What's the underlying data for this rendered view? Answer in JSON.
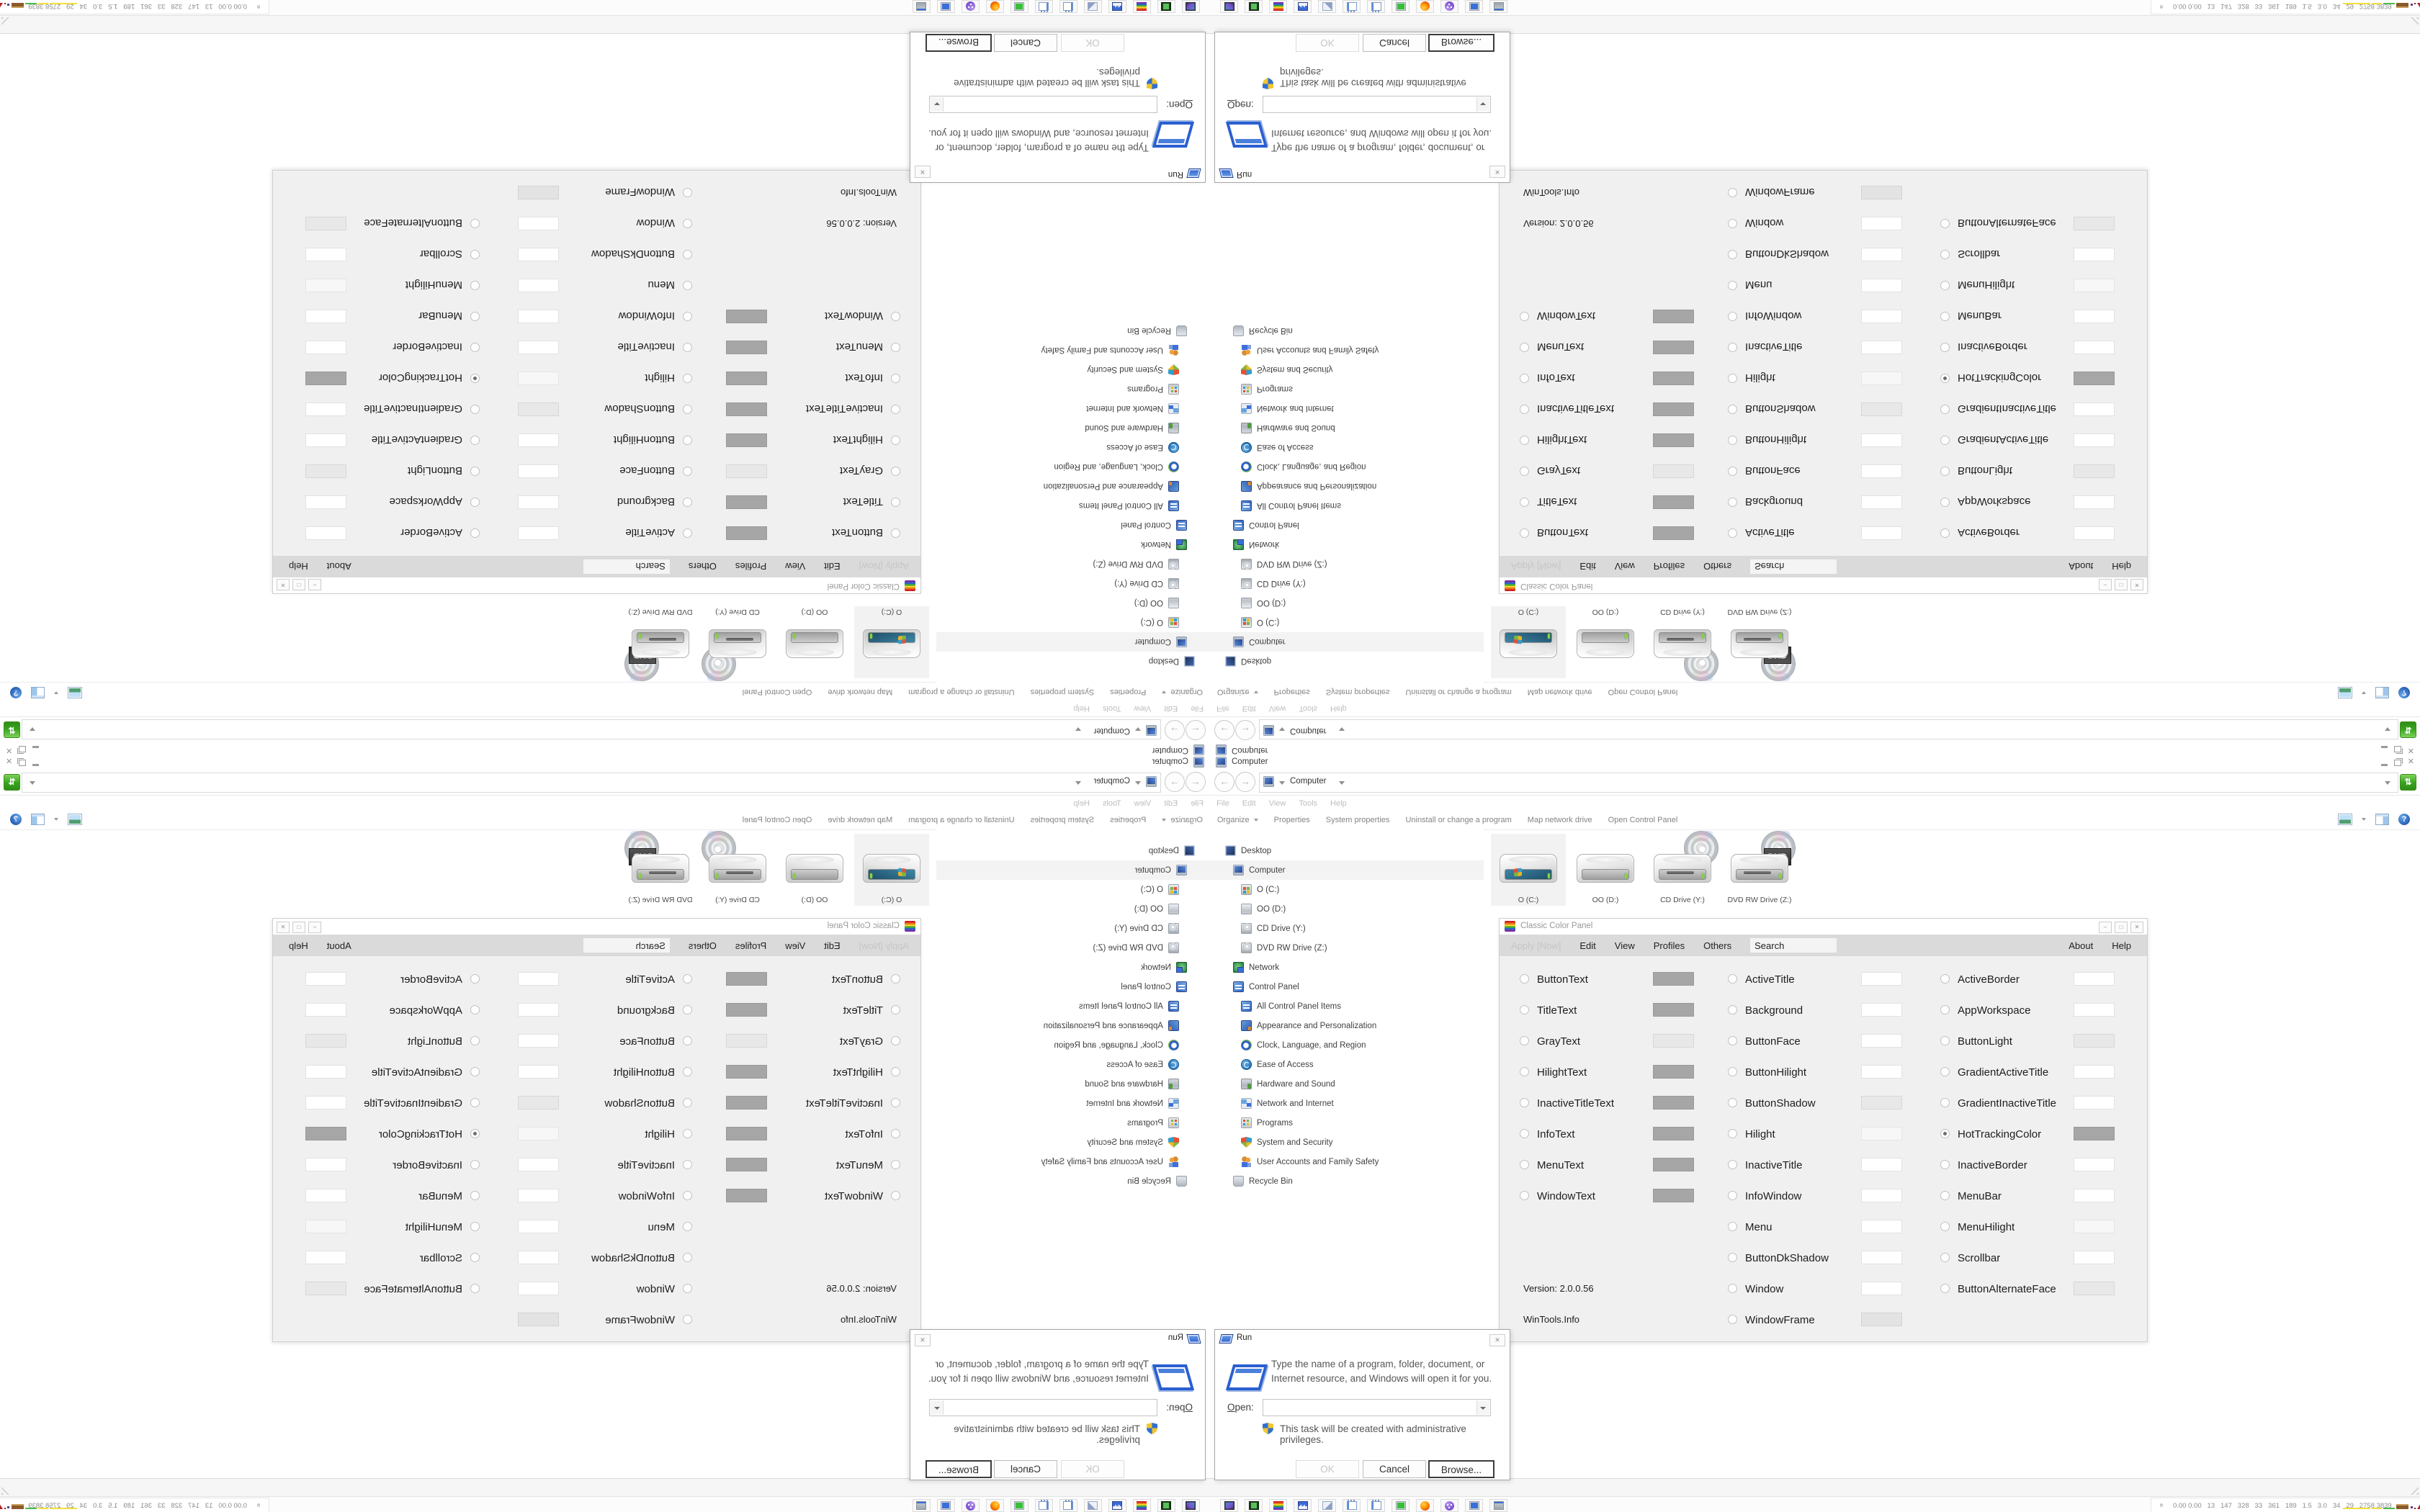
{
  "explorer": {
    "window_title": "Computer",
    "breadcrumb": "Computer",
    "menu_items": [
      "File",
      "Edit",
      "View",
      "Tools",
      "Help"
    ],
    "command_items": [
      "Organize",
      "Properties",
      "System properties",
      "Uninstall or change a program",
      "Map network drive",
      "Open Control Panel"
    ],
    "tree": [
      {
        "label": "Desktop",
        "icon": "desktop",
        "indent": 0
      },
      {
        "label": "Computer",
        "icon": "computer",
        "indent": 1,
        "selected": true
      },
      {
        "label": "O (C:)",
        "icon": "drive-c",
        "indent": 2
      },
      {
        "label": "OO (D:)",
        "icon": "drive",
        "indent": 2
      },
      {
        "label": "CD Drive (Y:)",
        "icon": "cd-drive",
        "indent": 2
      },
      {
        "label": "DVD RW Drive (Z:)",
        "icon": "dvd-drive",
        "indent": 2
      },
      {
        "label": "Network",
        "icon": "network",
        "indent": 1
      },
      {
        "label": "Control Panel",
        "icon": "control-panel",
        "indent": 1
      },
      {
        "label": "All Control Panel Items",
        "icon": "control-panel",
        "indent": 2
      },
      {
        "label": "Appearance and Personalization",
        "icon": "appearance",
        "indent": 2
      },
      {
        "label": "Clock, Language, and Region",
        "icon": "clock",
        "indent": 2
      },
      {
        "label": "Ease of Access",
        "icon": "ease",
        "indent": 2
      },
      {
        "label": "Hardware and Sound",
        "icon": "hardware",
        "indent": 2
      },
      {
        "label": "Network and Internet",
        "icon": "net",
        "indent": 2
      },
      {
        "label": "Programs",
        "icon": "programs",
        "indent": 2
      },
      {
        "label": "System and Security",
        "icon": "security",
        "indent": 2
      },
      {
        "label": "User Accounts and Family Safety",
        "icon": "users",
        "indent": 2
      },
      {
        "label": "Recycle Bin",
        "icon": "recycle",
        "indent": 1
      }
    ],
    "drives": [
      {
        "label": "O (C:)",
        "type": "hdd-windows",
        "selected": true
      },
      {
        "label": "OO (D:)",
        "type": "hdd"
      },
      {
        "label": "CD Drive (Y:)",
        "type": "cd"
      },
      {
        "label": "DVD RW Drive (Z:)",
        "type": "dvd",
        "badge": "DVD"
      }
    ]
  },
  "ccp": {
    "title": "Classic Color Panel",
    "menu": {
      "apply": "Apply [Now]",
      "edit": "Edit",
      "view": "View",
      "profiles": "Profiles",
      "others": "Others",
      "search_value": "Search",
      "about": "About",
      "help": "Help"
    },
    "version": "Version: 2.0.0.56",
    "site": "WinTools.Info",
    "col1": [
      {
        "label": "ButtonText",
        "color": "#a6a6a6"
      },
      {
        "label": "TitleText",
        "color": "#a6a6a6"
      },
      {
        "label": "GrayText",
        "color": "#e8e8e8"
      },
      {
        "label": "HilightText",
        "color": "#a6a6a6"
      },
      {
        "label": "InactiveTitleText",
        "color": "#a6a6a6"
      },
      {
        "label": "InfoText",
        "color": "#a6a6a6"
      },
      {
        "label": "MenuText",
        "color": "#a6a6a6"
      },
      {
        "label": "WindowText",
        "color": "#a6a6a6"
      }
    ],
    "col2": [
      {
        "label": "ActiveTitle",
        "color": "#ffffff"
      },
      {
        "label": "Background",
        "color": "#ffffff"
      },
      {
        "label": "ButtonFace",
        "color": "#ffffff"
      },
      {
        "label": "ButtonHilight",
        "color": "#ffffff"
      },
      {
        "label": "ButtonShadow",
        "color": "#e8e8e8"
      },
      {
        "label": "Hilight",
        "color": "#f7f7f7"
      },
      {
        "label": "InactiveTitle",
        "color": "#ffffff"
      },
      {
        "label": "InfoWindow",
        "color": "#ffffff"
      },
      {
        "label": "Menu",
        "color": "#ffffff"
      },
      {
        "label": "ButtonDkShadow",
        "color": "#ffffff"
      },
      {
        "label": "Window",
        "color": "#ffffff"
      },
      {
        "label": "WindowFrame",
        "color": "#e3e3e3"
      }
    ],
    "col3": [
      {
        "label": "ActiveBorder",
        "color": "#ffffff"
      },
      {
        "label": "AppWorkspace",
        "color": "#ffffff"
      },
      {
        "label": "ButtonLight",
        "color": "#e8e8e8"
      },
      {
        "label": "GradientActiveTitle",
        "color": "#ffffff"
      },
      {
        "label": "GradientInactiveTitle",
        "color": "#ffffff"
      },
      {
        "label": "HotTrackingColor",
        "color": "#a6a6a6",
        "selected": true
      },
      {
        "label": "InactiveBorder",
        "color": "#ffffff"
      },
      {
        "label": "MenuBar",
        "color": "#ffffff"
      },
      {
        "label": "MenuHilight",
        "color": "#f7f7f7"
      },
      {
        "label": "Scrollbar",
        "color": "#ffffff"
      },
      {
        "label": "ButtonAlternateFace",
        "color": "#e8e8e8"
      }
    ]
  },
  "run_dialog": {
    "title": "Run",
    "description": "Type the name of a program, folder, document, or Internet resource, and Windows will open it for you.",
    "open_label": "Open:",
    "open_value": "",
    "admin_note": "This task will be created with administrative privileges.",
    "buttons": {
      "ok": "OK",
      "cancel": "Cancel",
      "browse": "Browse..."
    }
  },
  "taskbar": {
    "apps": [
      {
        "icon": "monitor-dark"
      },
      {
        "icon": "green-book"
      },
      {
        "icon": "rainbow"
      },
      {
        "icon": "floppy",
        "badge": "64"
      },
      {
        "icon": "scroll"
      },
      {
        "icon": "notepad"
      },
      {
        "icon": "notepad"
      },
      {
        "icon": "monitor-green"
      },
      {
        "icon": "firefox"
      },
      {
        "icon": "purple-ball"
      },
      {
        "icon": "monitor-blue"
      },
      {
        "icon": "installer"
      }
    ],
    "tray_stats": "0.00 0.00   13   147   328   33   361   189   1.5   3.0   34   29   2758 3839"
  },
  "colors": {
    "swatch_gray": "#a6a6a6",
    "swatch_light": "#e8e8e8",
    "refresh_green": "#37a21e",
    "graph_yellow": "#f0e03c",
    "graph_green": "#4cbb4c",
    "graph_brown": "#8a5a28",
    "graph_red": "#b32222"
  }
}
